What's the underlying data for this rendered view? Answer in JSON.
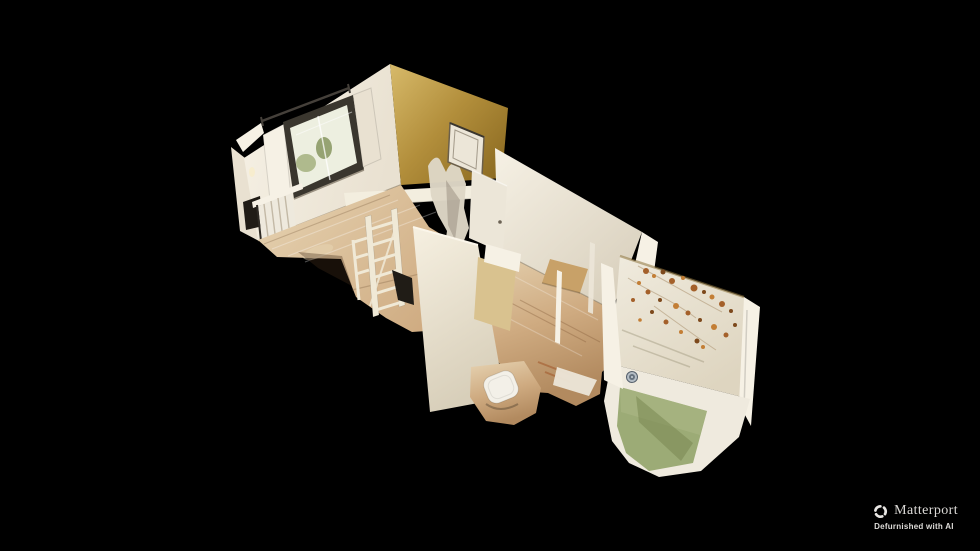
{
  "watermark": {
    "brand": "Matterport",
    "subtitle": "Defurnished with AI"
  },
  "scene": {
    "view": "dollhouse-3d-view",
    "description": "Overhead cutaway 3D scan of an unfurnished apartment: bedroom with window, curtain rod, radiator and gold accent wall; hallway with ladder shelving and open white doors; bathroom with shower tray; large room with cream walls; courtyard with vine-covered wall, green floor and drain cover; all floating on a black background"
  },
  "colors": {
    "bg": "#000000",
    "wallBright": "#f6f1e5",
    "wallWhite": "#e9e1d1",
    "wallShadow": "#d8cfbc",
    "goldLight": "#d7ba6a",
    "gold": "#b28e3b",
    "goldDark": "#8a6920",
    "ledge": "#f3eedf",
    "windowFrame": "#3a362e",
    "windowGlass": "#edefe0",
    "foliage": "#a3b07e",
    "foliageDark": "#7f9058",
    "rod": "#45403a",
    "radiator": "#eee9dd",
    "radiatorFin": "#c3b9a6",
    "recessDark": "#201c16",
    "floorLight": "#e6d3b2",
    "floorMid": "#cfab81",
    "floorDark": "#b28a5f",
    "partitionLight": "#f6f0e1",
    "partitionShadow": "#d8cfba",
    "doorWhite": "#ece6d8",
    "tanPanel": "#d9c28f",
    "counterTan": "#c8a168",
    "meltFragment": "#ded7c6",
    "trayWhite": "#f3f0e8",
    "courtWallLight": "#f0ebde",
    "courtWallShade": "#ded5c0",
    "vine": "#a4602a",
    "vineLight": "#c37e35",
    "vineDark": "#7d491c",
    "stem": "#b49d7c",
    "green": "#9cab76",
    "greenLight": "#aeba87",
    "greenDark": "#75844e",
    "paving": "#efeade",
    "drainOuter": "#b4bdc5",
    "drainInner": "#66727e",
    "drainDot": "#ccd3d9",
    "ladder": "#f0e9d6",
    "brandText": "#e8e6e3",
    "subtitleText": "#f0eeeb"
  }
}
